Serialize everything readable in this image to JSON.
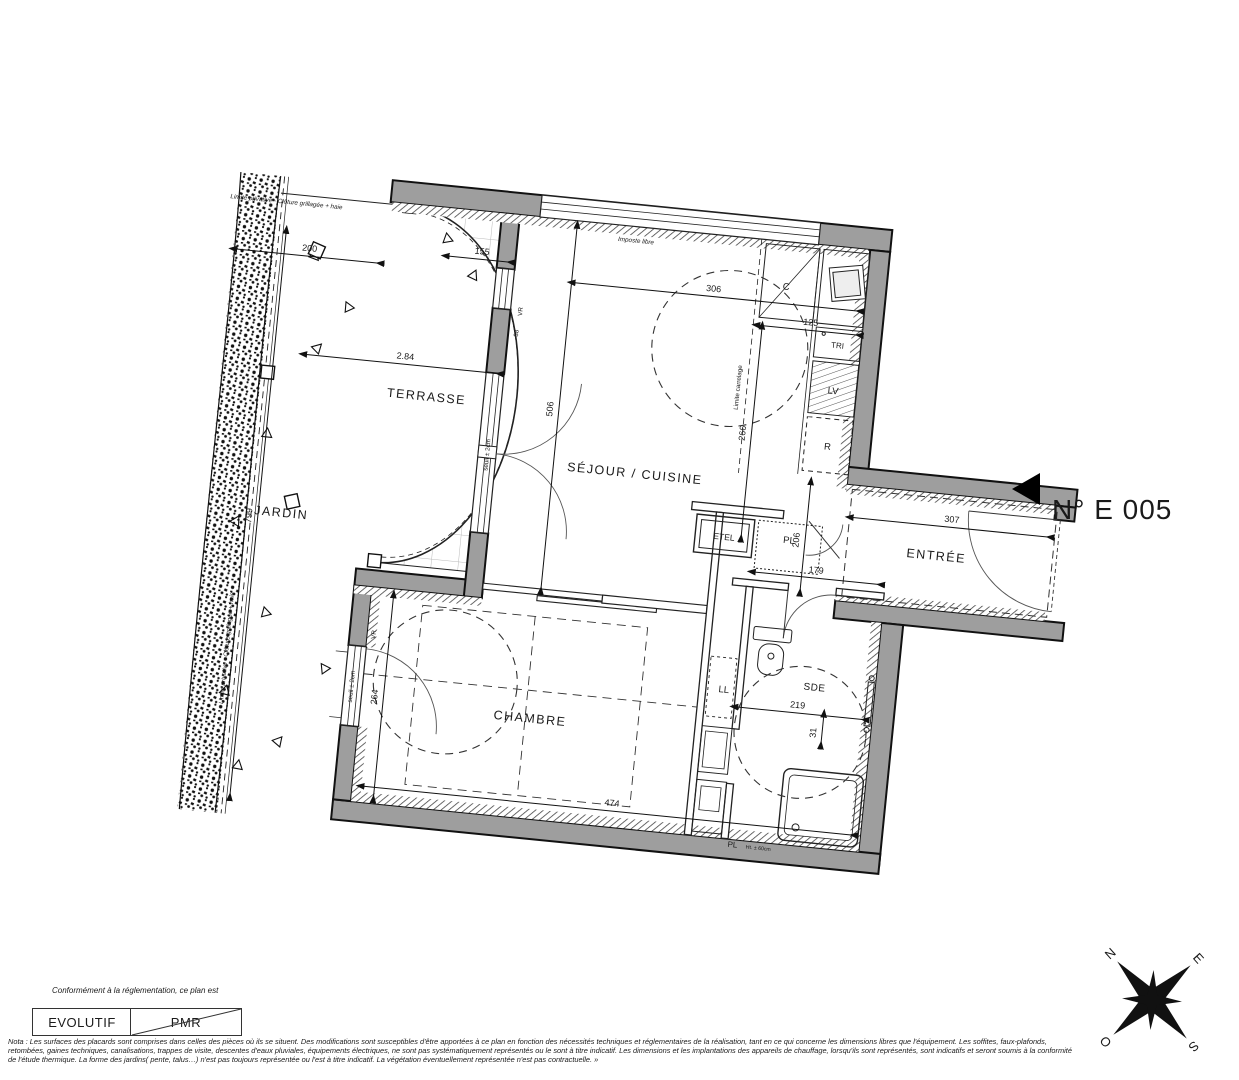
{
  "plan_number": "N° E 005",
  "colors": {
    "wall": "#9e9e9e",
    "line": "#1a1a1a"
  },
  "icons": {
    "unit_marker": "left-pointing-triangle",
    "compass": "compass-rose"
  },
  "rooms": {
    "terrasse": "TERRASSE",
    "jardin": "JARDIN",
    "sejour": "SÉJOUR / CUISINE",
    "entree": "ENTRÉE",
    "chambre": "CHAMBRE",
    "sde": "SDE",
    "etel": "ETEL",
    "pl1": "PL",
    "pl2": "PL",
    "ll": "LL"
  },
  "kitchen": {
    "c": "C",
    "tri": "TRI",
    "lv": "LV",
    "r": "R"
  },
  "dims": {
    "d200": "200",
    "d155": "155",
    "d284": "2.84",
    "d306": "306",
    "d125": "125",
    "d266": "266",
    "d506": "506",
    "d307": "307",
    "d206": "206",
    "d179": "179",
    "d219": "219",
    "d31": "31",
    "d474": "474",
    "d264": "264",
    "d799": "799",
    "d38": "38"
  },
  "annotations": {
    "limite_privative": "Limite privative - Clôture grillagée + haie",
    "limite_carrelage": "Limite carrelage",
    "imposte": "Imposte libre",
    "seuil": "seuil ± 2cm",
    "vr": "VR",
    "ht_pl": "Ht. ± 60cm"
  },
  "compass": {
    "n": "N",
    "e": "E",
    "s": "S",
    "o": "O"
  },
  "footer": {
    "caption": "Conformément à la réglementation, ce plan est",
    "evolutif": "EVOLUTIF",
    "pmr": "PMR",
    "note_line1": "Nota : Les surfaces des placards sont comprises dans celles des pièces où ils se situent. Des modifications sont susceptibles d'être apportées à ce plan en fonction des nécessités techniques et réglementaires de la réalisation, tant en ce qui concerne les dimensions libres que l'équipement.  Les soffites, faux-plafonds,",
    "note_line2": "retombées, gaines techniques, canalisations, trappes de visite, descentes d'eaux pluviales, équipements électriques, ne sont pas systématiquement représentés ou le sont à titre indicatif. Les dimensions et les implantations des appareils de chauffage, lorsqu'ils sont représentés, sont indicatifs et seront soumis à la conformité",
    "note_line3": "de l'étude thermique. La forme des jardins( pente, talus…) n'est pas toujours représentée ou l'est à titre indicatif. La végétation éventuellement représentée n'est pas contractuelle. »"
  }
}
